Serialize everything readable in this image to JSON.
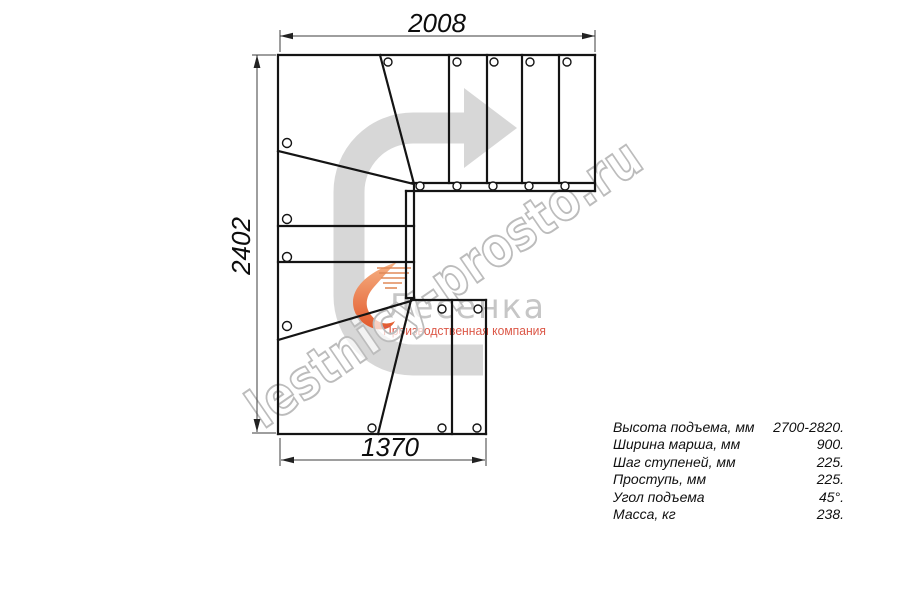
{
  "drawing": {
    "title": "staircase-plan",
    "dim_top_mm": "2008",
    "dim_side_mm": "2402",
    "dim_bottom_mm": "1370"
  },
  "watermark": {
    "text": "lestnicy-prosto.ru"
  },
  "logo": {
    "name": "Лесенка",
    "tagline": "Производственная компания"
  },
  "specs": {
    "rows": [
      {
        "label": "Высота подъема, мм",
        "value": "2700-2820."
      },
      {
        "label": "Ширина марша, мм",
        "value": "900."
      },
      {
        "label": "Шаг ступеней, мм",
        "value": "225."
      },
      {
        "label": "Проступь, мм",
        "value": "225."
      },
      {
        "label": "Угол подъема",
        "value": "45°."
      },
      {
        "label": "Масса, кг",
        "value": "238."
      }
    ]
  },
  "colors": {
    "line": "#141414",
    "dimension": "#3c3c3c",
    "arrow_gray": "#d7d7d7",
    "watermark_gray": "#bcbcbc",
    "logo_gray": "#c6c6c6",
    "logo_orange_light": "#f6b183",
    "logo_orange_dark": "#e2592c",
    "tagline_red": "#dc5848"
  }
}
